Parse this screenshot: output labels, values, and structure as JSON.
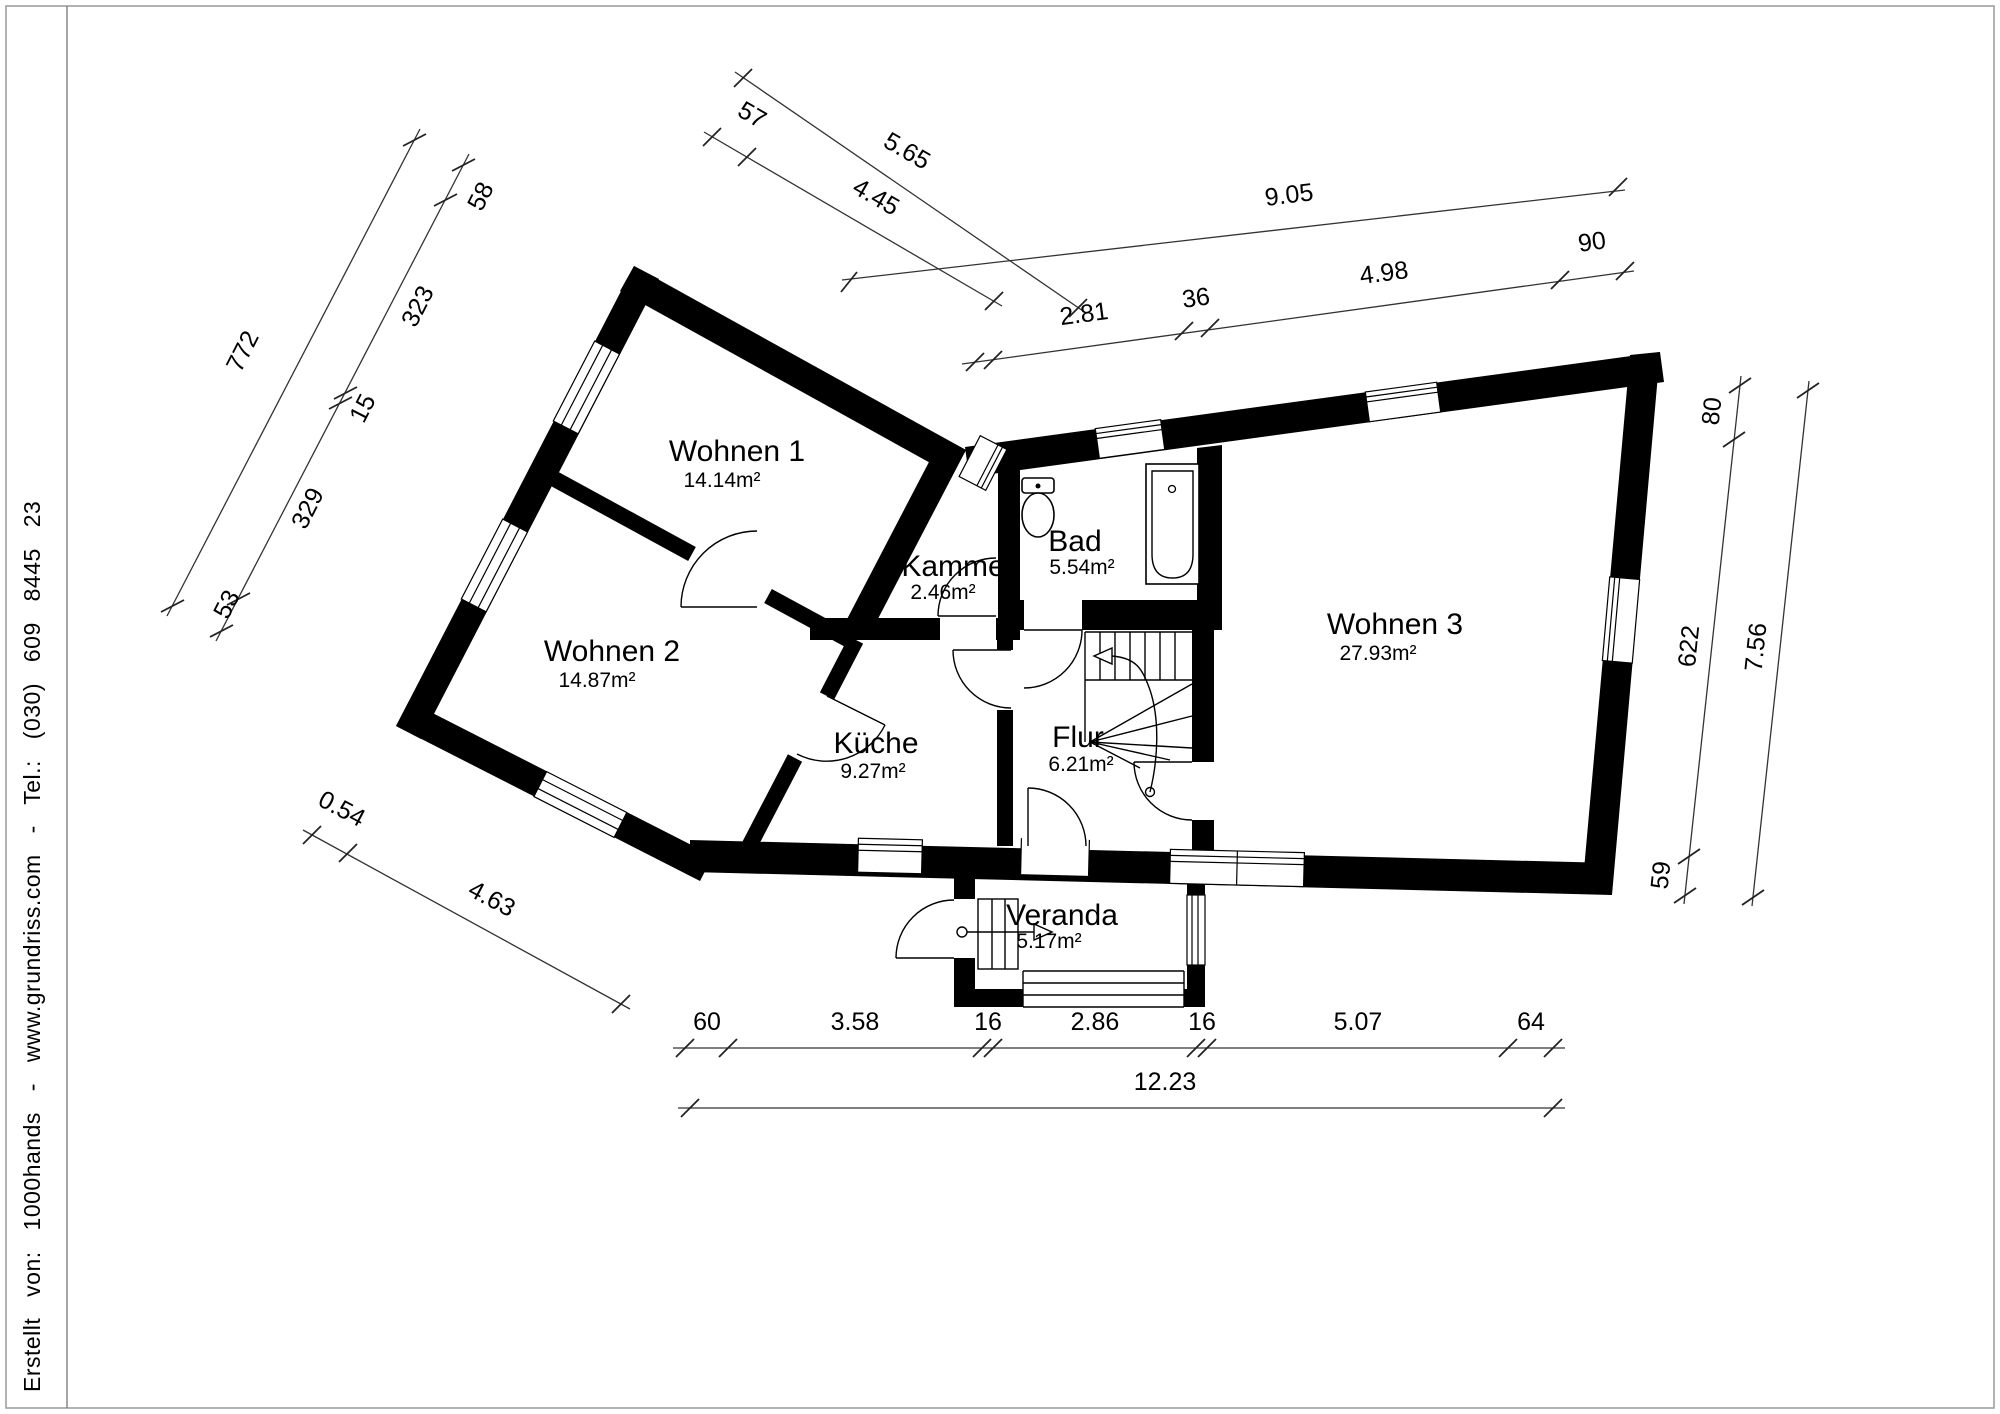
{
  "page": {
    "credit_line": "Erstellt von: 1000hands - www.grundriss.com - Tel.: (030) 609 8445 23"
  },
  "rooms": [
    {
      "name": "Wohnen 1",
      "area": "14.14m²"
    },
    {
      "name": "Wohnen 2",
      "area": "14.87m²"
    },
    {
      "name": "Wohnen 3",
      "area": "27.93m²"
    },
    {
      "name": "Kammer",
      "area": "2.46m²"
    },
    {
      "name": "Bad",
      "area": "5.54m²"
    },
    {
      "name": "Küche",
      "area": "9.27m²"
    },
    {
      "name": "Flur",
      "area": "6.21m²"
    },
    {
      "name": "Veranda",
      "area": "5.17m²"
    }
  ],
  "dimensions": {
    "top_outer": "5.65",
    "top_inner": [
      "57",
      "4.45"
    ],
    "top_right_outer": "9.05",
    "top_right_inner": [
      "2.81",
      "36",
      "4.98",
      "90"
    ],
    "left_outer": "772",
    "left_inner": [
      "58",
      "323",
      "15",
      "329",
      "53"
    ],
    "bottom_left": [
      "0.54",
      "4.63"
    ],
    "right_inner": [
      "80",
      "622",
      "59"
    ],
    "right_outer": "7.56",
    "bottom_inner": [
      "60",
      "3.58",
      "16",
      "2.86",
      "16",
      "5.07",
      "64"
    ],
    "bottom_outer": "12.23"
  }
}
